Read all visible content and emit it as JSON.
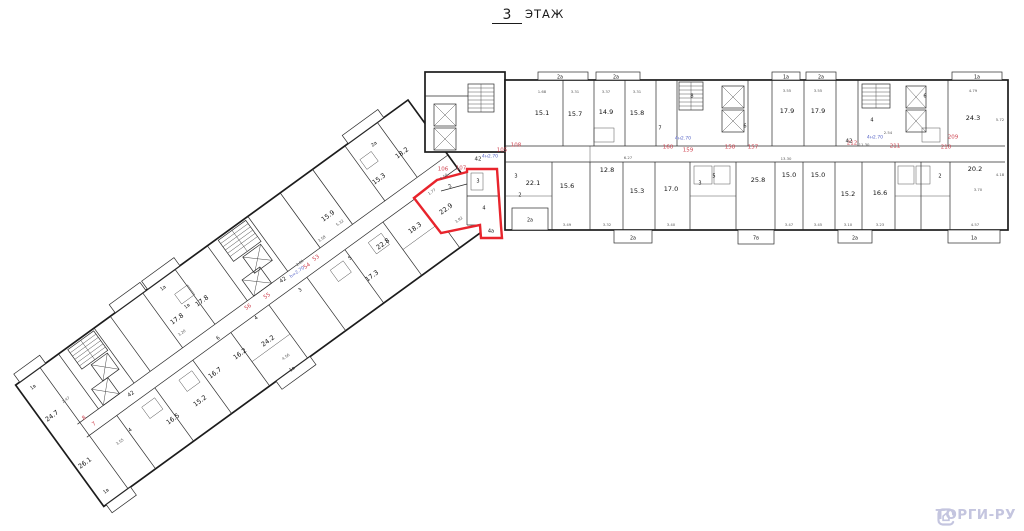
{
  "title": {
    "floor_number": "3",
    "floor_label": "ЭТАЖ"
  },
  "watermark": {
    "text": "ТОРГИ-РУ",
    "color": "#c4c5df"
  },
  "highlighted_apartment": {
    "outline_color": "#e8242c",
    "main_area": "22.9",
    "room_marks": [
      "2",
      "3",
      "4",
      "4а"
    ]
  },
  "plan": {
    "labels": [
      {
        "t": "15.1",
        "x": 542,
        "y": 113,
        "c": "room"
      },
      {
        "t": "15.7",
        "x": 575,
        "y": 114,
        "c": "room"
      },
      {
        "t": "14.9",
        "x": 606,
        "y": 112,
        "c": "room"
      },
      {
        "t": "15.8",
        "x": 637,
        "y": 113,
        "c": "room"
      },
      {
        "t": "17.9",
        "x": 787,
        "y": 111,
        "c": "room"
      },
      {
        "t": "17.9",
        "x": 818,
        "y": 111,
        "c": "room"
      },
      {
        "t": "24.3",
        "x": 973,
        "y": 118,
        "c": "room"
      },
      {
        "t": "22.1",
        "x": 533,
        "y": 183,
        "c": "room"
      },
      {
        "t": "15.6",
        "x": 567,
        "y": 186,
        "c": "room"
      },
      {
        "t": "12.8",
        "x": 607,
        "y": 170,
        "c": "room"
      },
      {
        "t": "15.3",
        "x": 637,
        "y": 191,
        "c": "room"
      },
      {
        "t": "17.0",
        "x": 671,
        "y": 189,
        "c": "room"
      },
      {
        "t": "25.8",
        "x": 758,
        "y": 180,
        "c": "room"
      },
      {
        "t": "15.0",
        "x": 789,
        "y": 175,
        "c": "room"
      },
      {
        "t": "15.0",
        "x": 818,
        "y": 175,
        "c": "room"
      },
      {
        "t": "15.2",
        "x": 848,
        "y": 194,
        "c": "room"
      },
      {
        "t": "16.6",
        "x": 880,
        "y": 193,
        "c": "room"
      },
      {
        "t": "20.2",
        "x": 975,
        "y": 169,
        "c": "room"
      },
      {
        "t": "22.9",
        "x": 446,
        "y": 209,
        "c": "room",
        "r": -36
      },
      {
        "t": "18.2",
        "x": 402,
        "y": 153,
        "c": "room",
        "r": -36
      },
      {
        "t": "15.3",
        "x": 379,
        "y": 179,
        "c": "room",
        "r": -36
      },
      {
        "t": "18.3",
        "x": 415,
        "y": 228,
        "c": "room",
        "r": -36
      },
      {
        "t": "22.8",
        "x": 383,
        "y": 244,
        "c": "room",
        "r": -36
      },
      {
        "t": "17.3",
        "x": 372,
        "y": 276,
        "c": "room",
        "r": -36
      },
      {
        "t": "15.9",
        "x": 328,
        "y": 216,
        "c": "room",
        "r": -36
      },
      {
        "t": "17.8",
        "x": 202,
        "y": 301,
        "c": "room",
        "r": -36
      },
      {
        "t": "17.8",
        "x": 177,
        "y": 319,
        "c": "room",
        "r": -36
      },
      {
        "t": "24.2",
        "x": 268,
        "y": 341,
        "c": "room",
        "r": -36
      },
      {
        "t": "16.2",
        "x": 240,
        "y": 354,
        "c": "room",
        "r": -36
      },
      {
        "t": "16.7",
        "x": 215,
        "y": 373,
        "c": "room",
        "r": -36
      },
      {
        "t": "15.2",
        "x": 200,
        "y": 401,
        "c": "room",
        "r": -36
      },
      {
        "t": "16.5",
        "x": 173,
        "y": 419,
        "c": "room",
        "r": -36
      },
      {
        "t": "24.7",
        "x": 52,
        "y": 416,
        "c": "room",
        "r": -36
      },
      {
        "t": "26.1",
        "x": 85,
        "y": 463,
        "c": "room",
        "r": -36
      },
      {
        "t": "160",
        "x": 668,
        "y": 147,
        "c": "apt"
      },
      {
        "t": "159",
        "x": 688,
        "y": 150,
        "c": "apt"
      },
      {
        "t": "158",
        "x": 730,
        "y": 147,
        "c": "apt"
      },
      {
        "t": "157",
        "x": 753,
        "y": 147,
        "c": "apt"
      },
      {
        "t": "212",
        "x": 852,
        "y": 143,
        "c": "apt"
      },
      {
        "t": "211",
        "x": 895,
        "y": 146,
        "c": "apt"
      },
      {
        "t": "210",
        "x": 946,
        "y": 147,
        "c": "apt"
      },
      {
        "t": "209",
        "x": 953,
        "y": 137,
        "c": "apt"
      },
      {
        "t": "105",
        "x": 502,
        "y": 150,
        "c": "apt"
      },
      {
        "t": "108",
        "x": 516,
        "y": 145,
        "c": "apt"
      },
      {
        "t": "106",
        "x": 443,
        "y": 169,
        "c": "apt"
      },
      {
        "t": "107",
        "x": 461,
        "y": 168,
        "c": "apt"
      },
      {
        "t": "53",
        "x": 316,
        "y": 258,
        "c": "apt",
        "r": -36
      },
      {
        "t": "54",
        "x": 307,
        "y": 266,
        "c": "apt",
        "r": -36
      },
      {
        "t": "55",
        "x": 267,
        "y": 296,
        "c": "apt",
        "r": -36
      },
      {
        "t": "56",
        "x": 248,
        "y": 307,
        "c": "apt",
        "r": -36
      },
      {
        "t": "8",
        "x": 84,
        "y": 418,
        "c": "apt",
        "r": -36
      },
      {
        "t": "7",
        "x": 94,
        "y": 424,
        "c": "apt",
        "r": -36
      },
      {
        "t": "4н2.70",
        "x": 683,
        "y": 138,
        "c": "note"
      },
      {
        "t": "4н2.70",
        "x": 875,
        "y": 137,
        "c": "note"
      },
      {
        "t": "4н2.70",
        "x": 490,
        "y": 156,
        "c": "note"
      },
      {
        "t": "h=2.70",
        "x": 297,
        "y": 272,
        "c": "note",
        "r": -36
      },
      {
        "t": "42",
        "x": 283,
        "y": 280,
        "c": "corr",
        "r": -36
      },
      {
        "t": "42",
        "x": 478,
        "y": 159,
        "c": "corr"
      },
      {
        "t": "42",
        "x": 849,
        "y": 141,
        "c": "corr"
      },
      {
        "t": "42",
        "x": 131,
        "y": 394,
        "c": "corr",
        "r": -36
      },
      {
        "t": "2а",
        "x": 560,
        "y": 77,
        "c": "bal"
      },
      {
        "t": "2а",
        "x": 616,
        "y": 77,
        "c": "bal"
      },
      {
        "t": "1а",
        "x": 786,
        "y": 77,
        "c": "bal"
      },
      {
        "t": "2а",
        "x": 821,
        "y": 77,
        "c": "bal"
      },
      {
        "t": "1а",
        "x": 977,
        "y": 77,
        "c": "bal"
      },
      {
        "t": "2а",
        "x": 633,
        "y": 238,
        "c": "bal"
      },
      {
        "t": "7в",
        "x": 756,
        "y": 238,
        "c": "bal"
      },
      {
        "t": "2а",
        "x": 855,
        "y": 238,
        "c": "bal"
      },
      {
        "t": "1а",
        "x": 974,
        "y": 238,
        "c": "bal"
      },
      {
        "t": "2а",
        "x": 530,
        "y": 220,
        "c": "bal"
      },
      {
        "t": "2а",
        "x": 374,
        "y": 144,
        "c": "bal",
        "r": -36
      },
      {
        "t": "1а",
        "x": 163,
        "y": 288,
        "c": "bal",
        "r": -36
      },
      {
        "t": "1в",
        "x": 187,
        "y": 306,
        "c": "bal",
        "r": -36
      },
      {
        "t": "1в",
        "x": 292,
        "y": 369,
        "c": "bal",
        "r": -36
      },
      {
        "t": "1в",
        "x": 33,
        "y": 387,
        "c": "bal",
        "r": -36
      },
      {
        "t": "1в",
        "x": 106,
        "y": 491,
        "c": "bal",
        "r": -36
      },
      {
        "t": "2",
        "x": 450,
        "y": 186,
        "c": "small",
        "r": -36
      },
      {
        "t": "3",
        "x": 478,
        "y": 181,
        "c": "small"
      },
      {
        "t": "4",
        "x": 484,
        "y": 208,
        "c": "small"
      },
      {
        "t": "4а",
        "x": 491,
        "y": 231,
        "c": "small"
      },
      {
        "t": "2",
        "x": 520,
        "y": 195,
        "c": "small"
      },
      {
        "t": "3",
        "x": 516,
        "y": 176,
        "c": "small"
      },
      {
        "t": "8",
        "x": 692,
        "y": 96,
        "c": "small"
      },
      {
        "t": "7",
        "x": 660,
        "y": 128,
        "c": "small"
      },
      {
        "t": "6",
        "x": 745,
        "y": 126,
        "c": "small"
      },
      {
        "t": "5",
        "x": 714,
        "y": 176,
        "c": "small"
      },
      {
        "t": "3",
        "x": 700,
        "y": 183,
        "c": "small"
      },
      {
        "t": "6",
        "x": 925,
        "y": 96,
        "c": "small"
      },
      {
        "t": "4",
        "x": 872,
        "y": 120,
        "c": "small"
      },
      {
        "t": "2",
        "x": 940,
        "y": 176,
        "c": "small"
      },
      {
        "t": "6",
        "x": 218,
        "y": 338,
        "c": "small",
        "r": -36
      },
      {
        "t": "4",
        "x": 256,
        "y": 318,
        "c": "small",
        "r": -36
      },
      {
        "t": "3",
        "x": 300,
        "y": 290,
        "c": "small",
        "r": -36
      },
      {
        "t": "5",
        "x": 350,
        "y": 258,
        "c": "small",
        "r": -36
      },
      {
        "t": "4",
        "x": 130,
        "y": 430,
        "c": "small",
        "r": -36
      },
      {
        "t": "1.68",
        "x": 542,
        "y": 92,
        "c": "dim"
      },
      {
        "t": "3.31",
        "x": 575,
        "y": 92,
        "c": "dim"
      },
      {
        "t": "3.37",
        "x": 606,
        "y": 92,
        "c": "dim"
      },
      {
        "t": "3.31",
        "x": 637,
        "y": 92,
        "c": "dim"
      },
      {
        "t": "3.55",
        "x": 787,
        "y": 91,
        "c": "dim"
      },
      {
        "t": "3.55",
        "x": 818,
        "y": 91,
        "c": "dim"
      },
      {
        "t": "4.79",
        "x": 973,
        "y": 91,
        "c": "dim"
      },
      {
        "t": "3.49",
        "x": 567,
        "y": 225,
        "c": "dim"
      },
      {
        "t": "3.32",
        "x": 607,
        "y": 225,
        "c": "dim"
      },
      {
        "t": "3.40",
        "x": 671,
        "y": 225,
        "c": "dim"
      },
      {
        "t": "3.47",
        "x": 789,
        "y": 225,
        "c": "dim"
      },
      {
        "t": "3.45",
        "x": 818,
        "y": 225,
        "c": "dim"
      },
      {
        "t": "3.10",
        "x": 848,
        "y": 225,
        "c": "dim"
      },
      {
        "t": "3.23",
        "x": 880,
        "y": 225,
        "c": "dim"
      },
      {
        "t": "4.57",
        "x": 975,
        "y": 225,
        "c": "dim"
      },
      {
        "t": "6.27",
        "x": 628,
        "y": 158,
        "c": "dim"
      },
      {
        "t": "13.30",
        "x": 786,
        "y": 159,
        "c": "dim"
      },
      {
        "t": "11.30",
        "x": 864,
        "y": 145,
        "c": "dim"
      },
      {
        "t": "2.54",
        "x": 888,
        "y": 133,
        "c": "dim"
      },
      {
        "t": "3.70",
        "x": 978,
        "y": 190,
        "c": "dim"
      },
      {
        "t": "5.72",
        "x": 1000,
        "y": 120,
        "c": "dim"
      },
      {
        "t": "4.18",
        "x": 1000,
        "y": 175,
        "c": "dim"
      },
      {
        "t": "3.92",
        "x": 459,
        "y": 220,
        "c": "dim",
        "r": -36
      },
      {
        "t": "1.77",
        "x": 432,
        "y": 192,
        "c": "dim",
        "r": -36
      },
      {
        "t": "3.50",
        "x": 444,
        "y": 177,
        "c": "dim",
        "r": -36
      },
      {
        "t": "5.32",
        "x": 340,
        "y": 223,
        "c": "dim",
        "r": -36
      },
      {
        "t": "3.58",
        "x": 322,
        "y": 239,
        "c": "dim",
        "r": -36
      },
      {
        "t": "2.81",
        "x": 300,
        "y": 263,
        "c": "dim",
        "r": -36
      },
      {
        "t": "3.20",
        "x": 182,
        "y": 333,
        "c": "dim",
        "r": -36
      },
      {
        "t": "4.56",
        "x": 286,
        "y": 357,
        "c": "dim",
        "r": -36
      },
      {
        "t": "3.55",
        "x": 120,
        "y": 442,
        "c": "dim",
        "r": -36
      },
      {
        "t": "2.47",
        "x": 66,
        "y": 400,
        "c": "dim",
        "r": -36
      }
    ]
  }
}
